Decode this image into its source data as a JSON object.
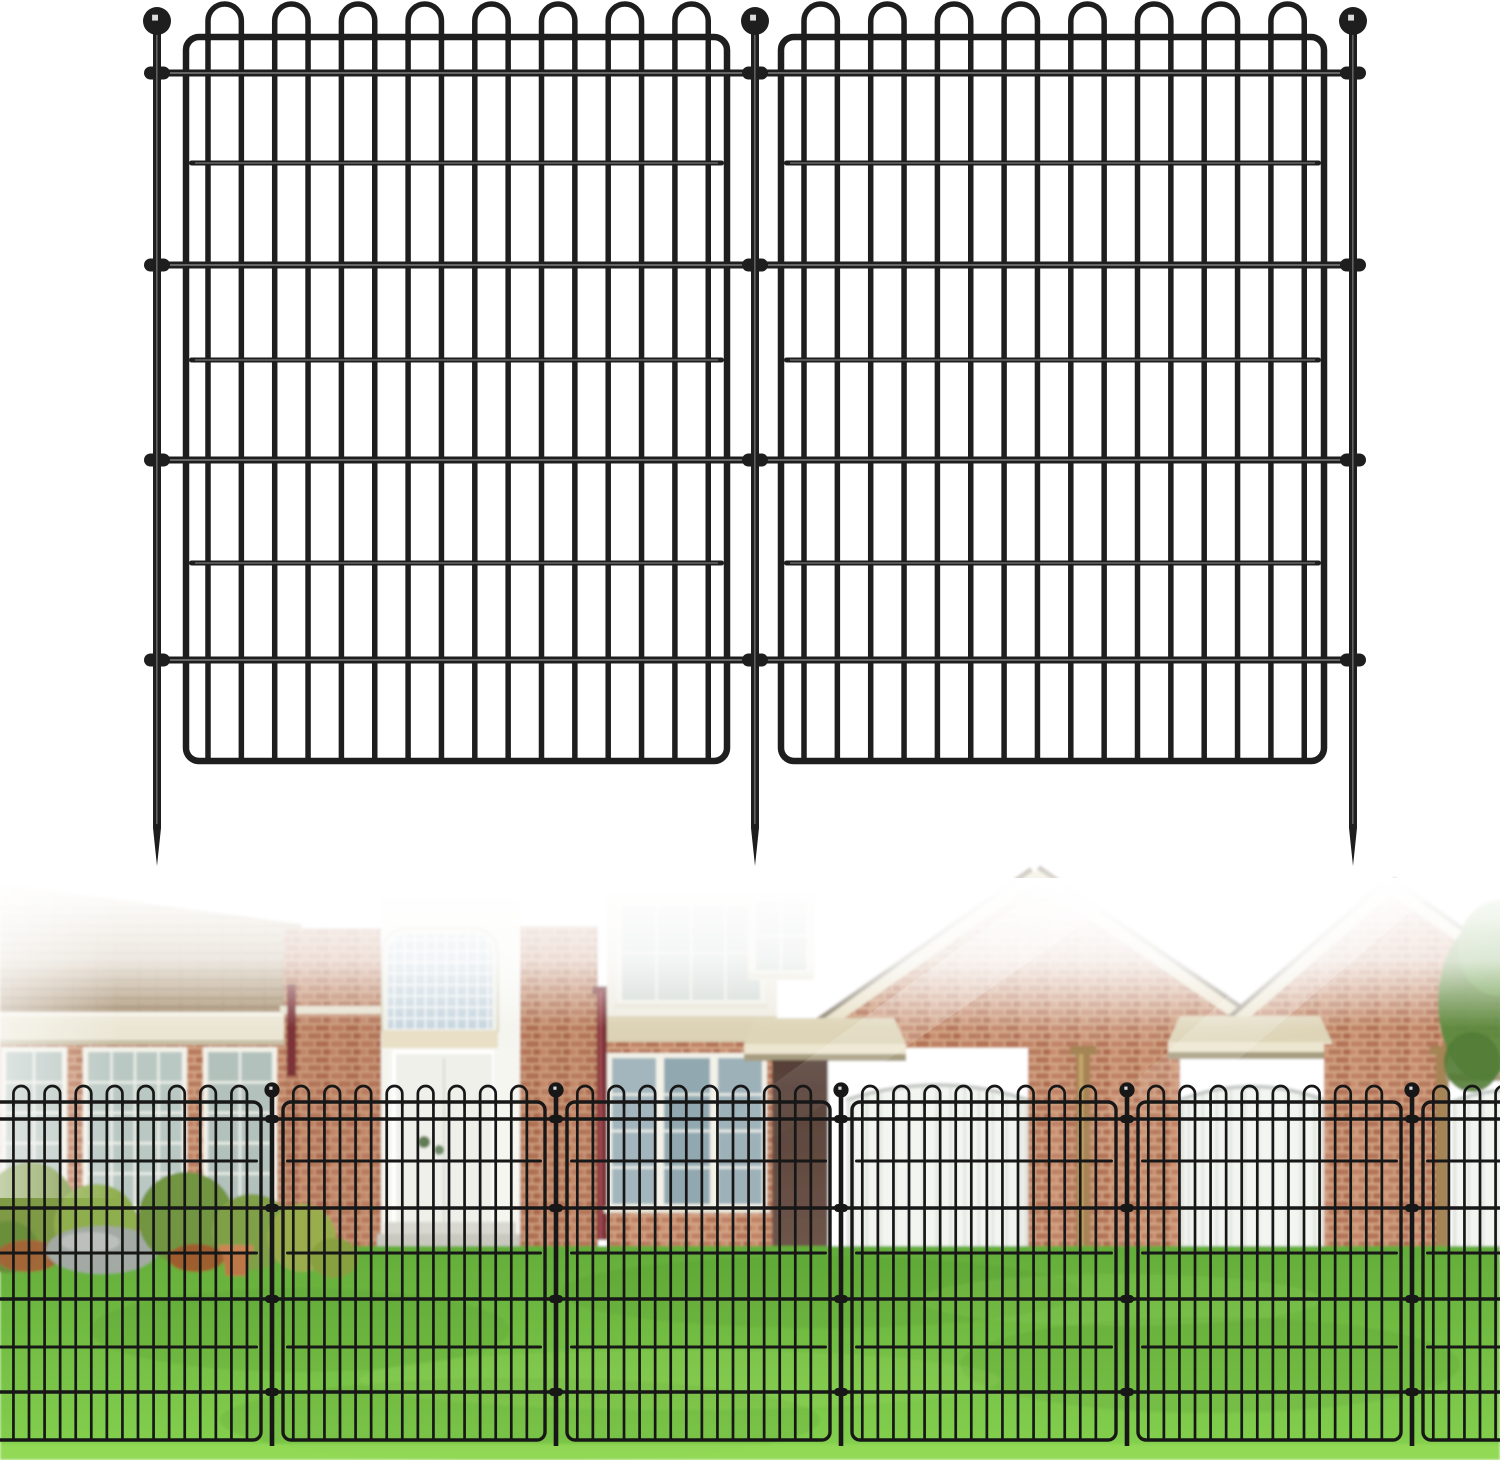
{
  "canvas": {
    "w": 1500,
    "h": 1460,
    "bg": "#ffffff"
  },
  "colors": {
    "wire": "#1e1e1e",
    "wirePhoto": "#171717",
    "mortar": "#d7ab8a",
    "brickA": "#c08266",
    "brickB": "#b37257",
    "brickC": "#c98e6f",
    "brickD": "#b87a5e",
    "brickE": "#ad6b50",
    "roofTop": "#d3c2a2",
    "roofBot": "#a68e6f",
    "shingleLine": "rgba(70,50,28,0.25)",
    "lawnTop": "#63ad39",
    "lawnBot": "#85d14f",
    "garageBg": "#f3f5f1",
    "garageRib": "#e0e4de",
    "garageTrim": "#c6cbc7",
    "garageJamb": "#dfe2dc",
    "glassBlock": "#c7d6df",
    "blockLine": "#f3f6f7",
    "shadowTop": "#564038",
    "shadowBot": "#70564a",
    "creamBoard": "#e9e1c8",
    "shingleEdge": "#8e8573",
    "canopySlab": "#ded5b8",
    "canopyFace": "#ece5cf",
    "canopyUnder": "#a79d80",
    "winFrame": "#f3f2e9",
    "winMuntin": "#eef0ea",
    "winSill": "#e9e6d8"
  },
  "diagram": {
    "wire": "#1e1e1e",
    "hl": true,
    "frame": {
      "top": 37,
      "bottom": 761,
      "r": 13,
      "w": 6.5
    },
    "panels": [
      {
        "x1": 186,
        "x2": 727,
        "barStart": 208
      },
      {
        "x1": 781,
        "x2": 1324,
        "barStart": 804
      }
    ],
    "bars": {
      "count": 16,
      "spacing": 33.35,
      "w": 5.5
    },
    "hoops": {
      "apex": 4,
      "w": 5.5
    },
    "fullRails": {
      "ys": [
        73,
        265,
        460,
        660
      ],
      "x1": 149,
      "x2": 1361,
      "w": 7
    },
    "innerRails": {
      "ys": [
        163,
        360,
        563
      ],
      "w": 5
    },
    "stakes": {
      "xs": [
        157,
        755,
        1353
      ],
      "w": 8,
      "top": 30,
      "bottom": 828,
      "tip": 38,
      "ball": {
        "cy": 21,
        "r": 14
      }
    },
    "clamp": {
      "w": 26,
      "h": 13
    }
  },
  "photoFence": {
    "wire": "#171717",
    "hl": false,
    "frame": {
      "top": 1102,
      "bottom": 1440,
      "r": 8,
      "w": 3.4
    },
    "panels": [
      {
        "x1": -28,
        "x2": 261
      },
      {
        "x1": 283,
        "x2": 545
      },
      {
        "x1": 567,
        "x2": 830
      },
      {
        "x1": 852,
        "x2": 1116
      },
      {
        "x1": 1138,
        "x2": 1401
      },
      {
        "x1": 1423,
        "x2": 1530
      }
    ],
    "barOffset": 10.3,
    "bars": {
      "spacing": 15.57,
      "w": 2.7
    },
    "hoops": {
      "apex": 1086,
      "w": 2.7
    },
    "fullRails": {
      "ys": [
        1119,
        1208,
        1299,
        1392
      ],
      "x1": -6,
      "x2": 1506,
      "w": 3.6
    },
    "innerRails": {
      "ys": [
        1161,
        1253,
        1347
      ],
      "w": 3
    },
    "stakes": {
      "xs": [
        272,
        556,
        841,
        1127,
        1412
      ],
      "w": 4.6,
      "top": 1097,
      "bottom": 1446,
      "tip": 0,
      "ball": {
        "cy": 1090,
        "r": 7.6
      }
    },
    "clamp": {
      "w": 14,
      "h": 8
    }
  },
  "scene": [
    {
      "t": "rect",
      "x": 0,
      "y": 878,
      "w": 1500,
      "h": 582,
      "f": "#ffffff",
      "n": "photo-background"
    },
    {
      "t": "poly",
      "p": [
        0,
        884,
        302,
        924,
        302,
        1016,
        0,
        1016
      ],
      "f": "@roof",
      "n": "left-roof"
    },
    {
      "t": "poly",
      "p": [
        0,
        884,
        302,
        924,
        302,
        1016,
        0,
        1016
      ],
      "f": "@shingle",
      "n": "left-roof-shingles"
    },
    {
      "t": "rect",
      "x": 0,
      "y": 1012,
      "w": 304,
      "h": 4,
      "f": "#f6f3e8",
      "n": "gutter-lip"
    },
    {
      "t": "rect",
      "x": 0,
      "y": 1016,
      "w": 304,
      "h": 26,
      "f": "#ebe6d4",
      "n": "fascia-board"
    },
    {
      "t": "rect",
      "x": 0,
      "y": 1040,
      "w": 304,
      "h": 5,
      "f": "#c8bfa6",
      "n": "fascia-shadow"
    },
    {
      "t": "rect",
      "x": 0,
      "y": 1045,
      "w": 290,
      "h": 212,
      "f": "@brick",
      "n": "left-brick-wall"
    },
    {
      "t": "win",
      "x": 6,
      "y": 1052,
      "w": 56,
      "h": 152,
      "g": "#b7c5c0",
      "mv": 1,
      "mh": 4,
      "n": "left-window-1"
    },
    {
      "t": "win",
      "x": 88,
      "y": 1052,
      "w": 94,
      "h": 152,
      "g": "#bac8c3",
      "mv": 3,
      "mh": 4,
      "n": "left-window-2"
    },
    {
      "t": "win",
      "x": 208,
      "y": 1052,
      "w": 64,
      "h": 152,
      "g": "#b3c1bc",
      "mv": 1,
      "mh": 4,
      "n": "left-window-3"
    },
    {
      "t": "rect",
      "x": 284,
      "y": 928,
      "w": 100,
      "h": 330,
      "f": "@brick",
      "n": "chimney"
    },
    {
      "t": "rect",
      "x": 284,
      "y": 928,
      "w": 100,
      "h": 330,
      "f": "#8a4a34",
      "o": 0.12,
      "n": "chimney-tint"
    },
    {
      "t": "rect",
      "x": 280,
      "y": 1006,
      "w": 108,
      "h": 8,
      "f": "#e7e1cf",
      "n": "chimney-cap"
    },
    {
      "t": "rect",
      "x": 287,
      "y": 984,
      "w": 9,
      "h": 92,
      "f": "#7c3038",
      "n": "maroon-downspout-small"
    },
    {
      "t": "rect",
      "x": 381,
      "y": 898,
      "w": 138,
      "h": 360,
      "f": "#f5f5f0",
      "n": "entry-tower-wall"
    },
    {
      "t": "gblock",
      "x": 388,
      "y": 934,
      "w": 104,
      "h": 98,
      "n": "glass-block-window"
    },
    {
      "t": "rect",
      "x": 382,
      "y": 1030,
      "w": 116,
      "h": 18,
      "f": "#e8dfc6",
      "n": "tower-trim-band"
    },
    {
      "t": "rect",
      "x": 396,
      "y": 1054,
      "w": 96,
      "h": 202,
      "f": "#eff0ea",
      "n": "front-doors"
    },
    {
      "t": "path",
      "d": "M394,1256 L394,1052 L494,1052 L494,1256",
      "f": "none",
      "s": "#ffffff",
      "w": 4,
      "n": "door-frame"
    },
    {
      "t": "line",
      "x1": 444,
      "y1": 1058,
      "x2": 444,
      "y2": 1252,
      "s": "#d8dad2",
      "w": 2,
      "n": "door-seam"
    },
    {
      "t": "ell",
      "cx": 424,
      "cy": 1142,
      "rx": 6,
      "ry": 6,
      "f": "#3f6030",
      "o": 0.8,
      "n": "door-wreath"
    },
    {
      "t": "ell",
      "cx": 439,
      "cy": 1150,
      "rx": 5,
      "ry": 5,
      "f": "#46683a",
      "o": 0.75,
      "n": "door-wreath"
    },
    {
      "t": "rect",
      "x": 494,
      "y": 1048,
      "w": 26,
      "h": 210,
      "f": "#f6f6f1",
      "n": "door-pillar"
    },
    {
      "t": "rect",
      "x": 384,
      "y": 1222,
      "w": 132,
      "h": 13,
      "f": "#d8d8d0",
      "n": "entry-step-upper"
    },
    {
      "t": "rect",
      "x": 377,
      "y": 1234,
      "w": 147,
      "h": 14,
      "f": "#c9c9c0",
      "n": "entry-step-lower"
    },
    {
      "t": "rect",
      "x": 520,
      "y": 926,
      "w": 78,
      "h": 332,
      "f": "@brick",
      "n": "chimney-2"
    },
    {
      "t": "rect",
      "x": 520,
      "y": 926,
      "w": 78,
      "h": 332,
      "f": "#8a4a34",
      "o": 0.1,
      "n": "chimney-2-tint"
    },
    {
      "t": "rect",
      "x": 592,
      "y": 986,
      "w": 18,
      "h": 8,
      "f": "#7c3038",
      "n": "maroon-downspout-elbow"
    },
    {
      "t": "rect",
      "x": 597,
      "y": 992,
      "w": 10,
      "h": 248,
      "f": "#7c3038",
      "n": "maroon-downspout"
    },
    {
      "t": "rect",
      "x": 599,
      "y": 992,
      "w": 3,
      "h": 248,
      "f": "#9f4850",
      "n": "maroon-downspout-highlight"
    },
    {
      "t": "rect",
      "x": 607,
      "y": 894,
      "w": 170,
      "h": 124,
      "f": "#efece2",
      "n": "upper-siding"
    },
    {
      "t": "win",
      "x": 622,
      "y": 906,
      "w": 138,
      "h": 94,
      "g": "#d2d9d5",
      "mv": 3,
      "mh": 1,
      "n": "upper-window"
    },
    {
      "t": "rect",
      "x": 607,
      "y": 1016,
      "w": 170,
      "h": 26,
      "f": "#dcd2b5",
      "n": "siding-band"
    },
    {
      "t": "rect",
      "x": 607,
      "y": 1042,
      "w": 172,
      "h": 216,
      "f": "@brick",
      "n": "mid-brick-wall"
    },
    {
      "t": "win",
      "x": 612,
      "y": 1058,
      "w": 44,
      "h": 146,
      "g": "#a3b6bd",
      "mv": 0,
      "mh": 3,
      "n": "narrow-window-1"
    },
    {
      "t": "win",
      "x": 664,
      "y": 1058,
      "w": 46,
      "h": 146,
      "g": "#92a8b0",
      "mv": 0,
      "mh": 3,
      "n": "narrow-window-2"
    },
    {
      "t": "win",
      "x": 718,
      "y": 1058,
      "w": 44,
      "h": 146,
      "g": "#9db1b9",
      "mv": 0,
      "mh": 3,
      "n": "narrow-window-3"
    },
    {
      "t": "rect",
      "x": 748,
      "y": 892,
      "w": 66,
      "h": 88,
      "f": "#f0ede4",
      "n": "gable-siding-patch"
    },
    {
      "t": "win",
      "x": 756,
      "y": 902,
      "w": 50,
      "h": 68,
      "g": "#cfd6d2",
      "mv": 1,
      "mh": 1,
      "n": "gable-window"
    },
    {
      "t": "poly",
      "p": [
        788,
        1048,
        1035,
        874,
        1284,
        1048
      ],
      "f": "@brick",
      "n": "gable-1-brick"
    },
    {
      "t": "gdoor",
      "x": 846,
      "y": 1080,
      "w": 182,
      "h": 178,
      "rise": 20,
      "n": "garage-door-1"
    },
    {
      "t": "rect",
      "x": 1028,
      "y": 1044,
      "w": 152,
      "h": 214,
      "f": "@brick",
      "n": "brick-pier-1"
    },
    {
      "t": "rect",
      "x": 1070,
      "y": 1046,
      "w": 26,
      "h": 9,
      "f": "#a58454",
      "n": "bronze-downspout-elbow"
    },
    {
      "t": "rect",
      "x": 1076,
      "y": 1054,
      "w": 14,
      "h": 204,
      "f": "#a58454",
      "n": "bronze-downspout"
    },
    {
      "t": "rect",
      "x": 1079,
      "y": 1054,
      "w": 4,
      "h": 204,
      "f": "#c8a66a",
      "n": "bronze-downspout-highlight"
    },
    {
      "t": "barge",
      "x1": 792,
      "y1": 1048,
      "x2": 1036,
      "y2": 876,
      "n": "gable-1-bargeboard-left"
    },
    {
      "t": "barge",
      "x1": 1034,
      "y1": 874,
      "x2": 1286,
      "y2": 1048,
      "n": "gable-1-bargeboard-right"
    },
    {
      "t": "canopy",
      "x": 744,
      "y": 1018,
      "w": 162,
      "n": "canopy-left"
    },
    {
      "t": "rect",
      "x": 772,
      "y": 1060,
      "w": 56,
      "h": 198,
      "f": "@shadow",
      "n": "shadow-column"
    },
    {
      "t": "poly",
      "p": [
        1200,
        1048,
        1388,
        886,
        1500,
        966,
        1500,
        1048
      ],
      "f": "@brick",
      "n": "gable-2-brick"
    },
    {
      "t": "barge",
      "x1": 1204,
      "y1": 1050,
      "x2": 1390,
      "y2": 888,
      "n": "gable-2-bargeboard-left"
    },
    {
      "t": "barge",
      "x1": 1388,
      "y1": 886,
      "x2": 1510,
      "y2": 972,
      "n": "gable-2-bargeboard-right"
    },
    {
      "t": "canopy",
      "x": 1168,
      "y": 1016,
      "w": 164,
      "n": "canopy-mid"
    },
    {
      "t": "gdoor",
      "x": 1180,
      "y": 1082,
      "w": 144,
      "h": 176,
      "rise": 18,
      "n": "garage-door-2"
    },
    {
      "t": "rect",
      "x": 1324,
      "y": 1044,
      "w": 120,
      "h": 214,
      "f": "@brick",
      "n": "brick-pier-2"
    },
    {
      "t": "rect",
      "x": 1430,
      "y": 1046,
      "w": 24,
      "h": 9,
      "f": "#a58454",
      "n": "bronze-downspout-elbow-2"
    },
    {
      "t": "rect",
      "x": 1436,
      "y": 1054,
      "w": 13,
      "h": 204,
      "f": "#a58454",
      "n": "bronze-downspout-2"
    },
    {
      "t": "canopy",
      "x": 1446,
      "y": 1038,
      "w": 70,
      "n": "canopy-right"
    },
    {
      "t": "gdoor",
      "x": 1452,
      "y": 1086,
      "w": 120,
      "h": 172,
      "rise": 16,
      "n": "garage-door-3"
    },
    {
      "t": "ell",
      "cx": 1482,
      "cy": 1002,
      "rx": 44,
      "ry": 78,
      "f": "#5d8a3e",
      "o": 0.95,
      "n": "tree"
    },
    {
      "t": "ell",
      "cx": 1500,
      "cy": 948,
      "rx": 42,
      "ry": 48,
      "f": "#6e9e4c",
      "o": 0.9,
      "n": "tree"
    },
    {
      "t": "ell",
      "cx": 1472,
      "cy": 1062,
      "rx": 28,
      "ry": 30,
      "f": "#527c36",
      "o": 0.9,
      "n": "tree"
    },
    {
      "t": "rect",
      "x": 0,
      "y": 1246,
      "w": 1500,
      "h": 214,
      "f": "@lawn",
      "n": "lawn"
    },
    {
      "t": "ell",
      "cx": 300,
      "cy": 1330,
      "rx": 210,
      "ry": 42,
      "f": "#3f7a22",
      "o": 0.12,
      "n": "lawn-shade"
    },
    {
      "t": "ell",
      "cx": 820,
      "cy": 1292,
      "rx": 260,
      "ry": 36,
      "f": "#3f7a22",
      "o": 0.1,
      "n": "lawn-shade"
    },
    {
      "t": "ell",
      "cx": 1210,
      "cy": 1365,
      "rx": 250,
      "ry": 48,
      "f": "#3f7a22",
      "o": 0.12,
      "n": "lawn-shade"
    },
    {
      "t": "ell",
      "cx": 520,
      "cy": 1420,
      "rx": 300,
      "ry": 42,
      "f": "#2f6a18",
      "o": 0.1,
      "n": "lawn-shade"
    },
    {
      "t": "ell",
      "cx": 680,
      "cy": 1380,
      "rx": 320,
      "ry": 30,
      "f": "#b8ec7a",
      "o": 0.14,
      "n": "lawn-light"
    },
    {
      "t": "ell",
      "cx": 1120,
      "cy": 1300,
      "rx": 200,
      "ry": 26,
      "f": "#b8ec7a",
      "o": 0.12,
      "n": "lawn-light"
    },
    {
      "t": "rect",
      "x": 0,
      "y": 1444,
      "w": 1500,
      "h": 16,
      "f": "#93d957",
      "o": 0.9,
      "n": "lawn-bright-edge"
    },
    {
      "t": "ell",
      "cx": 30,
      "cy": 1210,
      "rx": 46,
      "ry": 48,
      "f": "#7e9a45",
      "n": "bush"
    },
    {
      "t": "ell",
      "cx": 96,
      "cy": 1224,
      "rx": 42,
      "ry": 40,
      "f": "#8fae4e",
      "n": "bush"
    },
    {
      "t": "ell",
      "cx": 8,
      "cy": 1247,
      "rx": 30,
      "ry": 26,
      "f": "#6a8f3a",
      "n": "bush"
    },
    {
      "t": "ell",
      "cx": 28,
      "cy": 1256,
      "rx": 32,
      "ry": 16,
      "f": "#a8603a",
      "o": 0.9,
      "n": "rust-plant"
    },
    {
      "t": "ell",
      "cx": 102,
      "cy": 1250,
      "rx": 56,
      "ry": 24,
      "f": "#a3aaa3",
      "n": "boulder"
    },
    {
      "t": "ell",
      "cx": 90,
      "cy": 1242,
      "rx": 30,
      "ry": 10,
      "f": "#c0c6bf",
      "o": 0.8,
      "n": "boulder-highlight"
    },
    {
      "t": "ell",
      "cx": 186,
      "cy": 1218,
      "rx": 48,
      "ry": 46,
      "f": "#71953f",
      "n": "bush"
    },
    {
      "t": "ell",
      "cx": 252,
      "cy": 1232,
      "rx": 40,
      "ry": 38,
      "f": "#7fa047",
      "n": "bush"
    },
    {
      "t": "ell",
      "cx": 196,
      "cy": 1258,
      "rx": 28,
      "ry": 14,
      "f": "#a4552e",
      "o": 0.9,
      "n": "rust-plant"
    },
    {
      "t": "poly",
      "p": [
        222,
        1250,
        250,
        1250,
        246,
        1276,
        226,
        1276
      ],
      "f": "#bd7747",
      "n": "terracotta-pot"
    },
    {
      "t": "rect",
      "x": 219,
      "y": 1245,
      "w": 34,
      "h": 7,
      "f": "#cd8554",
      "n": "terracotta-pot-rim"
    },
    {
      "t": "ell",
      "cx": 302,
      "cy": 1238,
      "rx": 34,
      "ry": 34,
      "f": "#9aad4e",
      "n": "bush"
    },
    {
      "t": "ell",
      "cx": 334,
      "cy": 1258,
      "rx": 24,
      "ry": 20,
      "f": "#88a040",
      "n": "bush"
    }
  ],
  "glare": [
    {
      "t": "rect",
      "x": 0,
      "y": 878,
      "w": 1500,
      "h": 150,
      "f": "@fadeTop",
      "n": "sky-white-fade"
    },
    {
      "t": "rect",
      "x": 0,
      "y": 878,
      "w": 120,
      "h": 320,
      "f": "@fadeLeft",
      "o": 0.55,
      "n": "left-white-fade"
    },
    {
      "t": "ell",
      "cx": 1120,
      "cy": 900,
      "rx": 430,
      "ry": 150,
      "f": "@radialW",
      "o": 0.9,
      "n": "sun-glare"
    },
    {
      "t": "poly",
      "p": [
        1055,
        878,
        1150,
        878,
        765,
        1145,
        690,
        1145
      ],
      "f": "@ray",
      "o": 0.5,
      "n": "light-ray"
    },
    {
      "t": "poly",
      "p": [
        1355,
        878,
        1450,
        878,
        1115,
        1165,
        1045,
        1165
      ],
      "f": "@ray",
      "o": 0.45,
      "n": "light-ray"
    }
  ]
}
